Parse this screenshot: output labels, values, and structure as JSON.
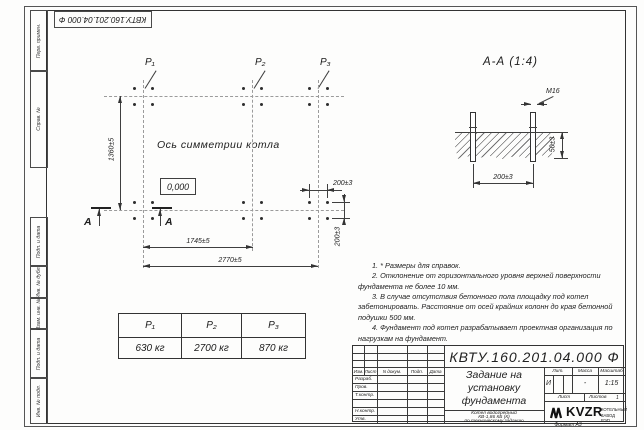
{
  "stamp_vertical": {
    "designation_rotated": "КВТУ.160.201.04.000 Ф"
  },
  "side_strip": {
    "labels": [
      "Перв. примен.",
      "Справ. №",
      "Подп. и дата",
      "Инв. № дубл.",
      "Взам. инв. №",
      "Подп. и дата",
      "Инв. № подл."
    ]
  },
  "plan": {
    "point_labels": [
      "P₁",
      "P₂",
      "P₃"
    ],
    "axis_label": "Ось симметрии котла",
    "level_mark": "0,000",
    "dims": {
      "height": "1360±5",
      "width_inner": "1745±5",
      "width_outer": "2770±5",
      "pitch_h": "200±3",
      "pitch_v": "200±3"
    },
    "section_letter": "А"
  },
  "section_view": {
    "title": "А-А (1:4)",
    "bolt_thread": "М16",
    "dims": {
      "embed_depth": "50±3",
      "bolt_spacing": "200±3"
    }
  },
  "notes": [
    "1. * Размеры для справок.",
    "2. Отклонение от горизонтального уровня верхней поверхности фундамента не более 10 мм.",
    "3. В случае отсутствия бетонного пола площадку под котел забетонировать. Расстояние от осей крайних колонн до края бетонной подушки 500 мм.",
    "4. Фундамент под котел разрабатывает проектная организация по нагрузкам на фундамент."
  ],
  "load_table": {
    "headers": [
      "P₁",
      "P₂",
      "P₃"
    ],
    "values": [
      "630 кг",
      "2700 кг",
      "870 кг"
    ]
  },
  "title_block": {
    "designation": "КВТУ.160.201.04.000 Ф",
    "title_lines": [
      "Задание на",
      "установку",
      "фундамента"
    ],
    "subtitle_lines": [
      "Котел водогрейный",
      "КВ-1,86 КБ (К)",
      "по техническому заданию"
    ],
    "change_cols": [
      "Изм.",
      "Лист",
      "N докум.",
      "Подп.",
      "Дата"
    ],
    "sig_rows": [
      "Разраб.",
      "Пров.",
      "Т.контр.",
      "Н.контр.",
      "Утв."
    ],
    "lit_header": "Лит.",
    "mass_header": "Масса",
    "scale_header": "Масштаб",
    "lit_value": "И",
    "mass_value": "-",
    "scale_value": "1:15",
    "sheet_label": "Лист",
    "sheets_label": "Листов",
    "sheets_value": "1",
    "logo_text": "KVZR",
    "logo_caption_lines": [
      "КОТЕЛЬНЫЙ",
      "ЗАВОД РЭП"
    ],
    "format_label": "Формат А3"
  }
}
